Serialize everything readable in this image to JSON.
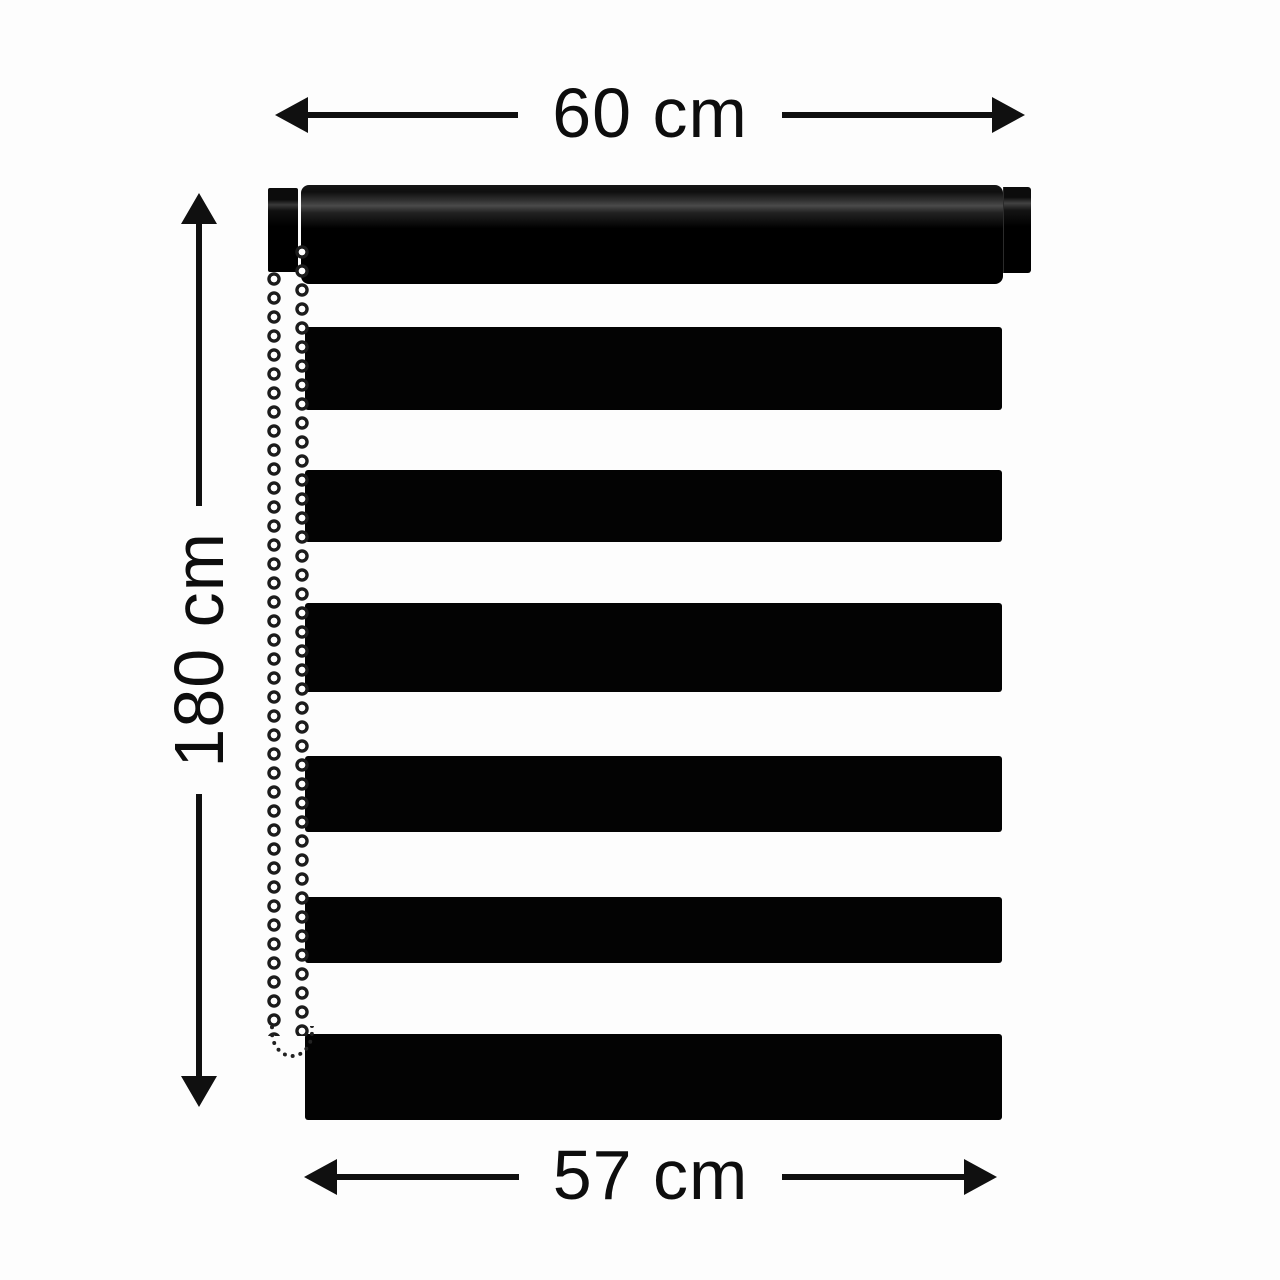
{
  "page": {
    "description": "Dimension diagram of a black day-night roller blind with bead chain"
  },
  "labels": {
    "width_top": "60 cm",
    "height_left": "180 cm",
    "width_bottom": "57 cm"
  },
  "blind": {
    "type": "zebra-roller-blind",
    "stripe_count": 6,
    "chain_side": "left",
    "colors": {
      "fabric_stripe": "#030303",
      "roller": "#000000",
      "background": "#fdfdfd",
      "dimension_text": "#0d0d0d",
      "arrow": "#101010",
      "chain_ring": "#1c1c1c",
      "chain_bead": "#ffffff"
    }
  }
}
